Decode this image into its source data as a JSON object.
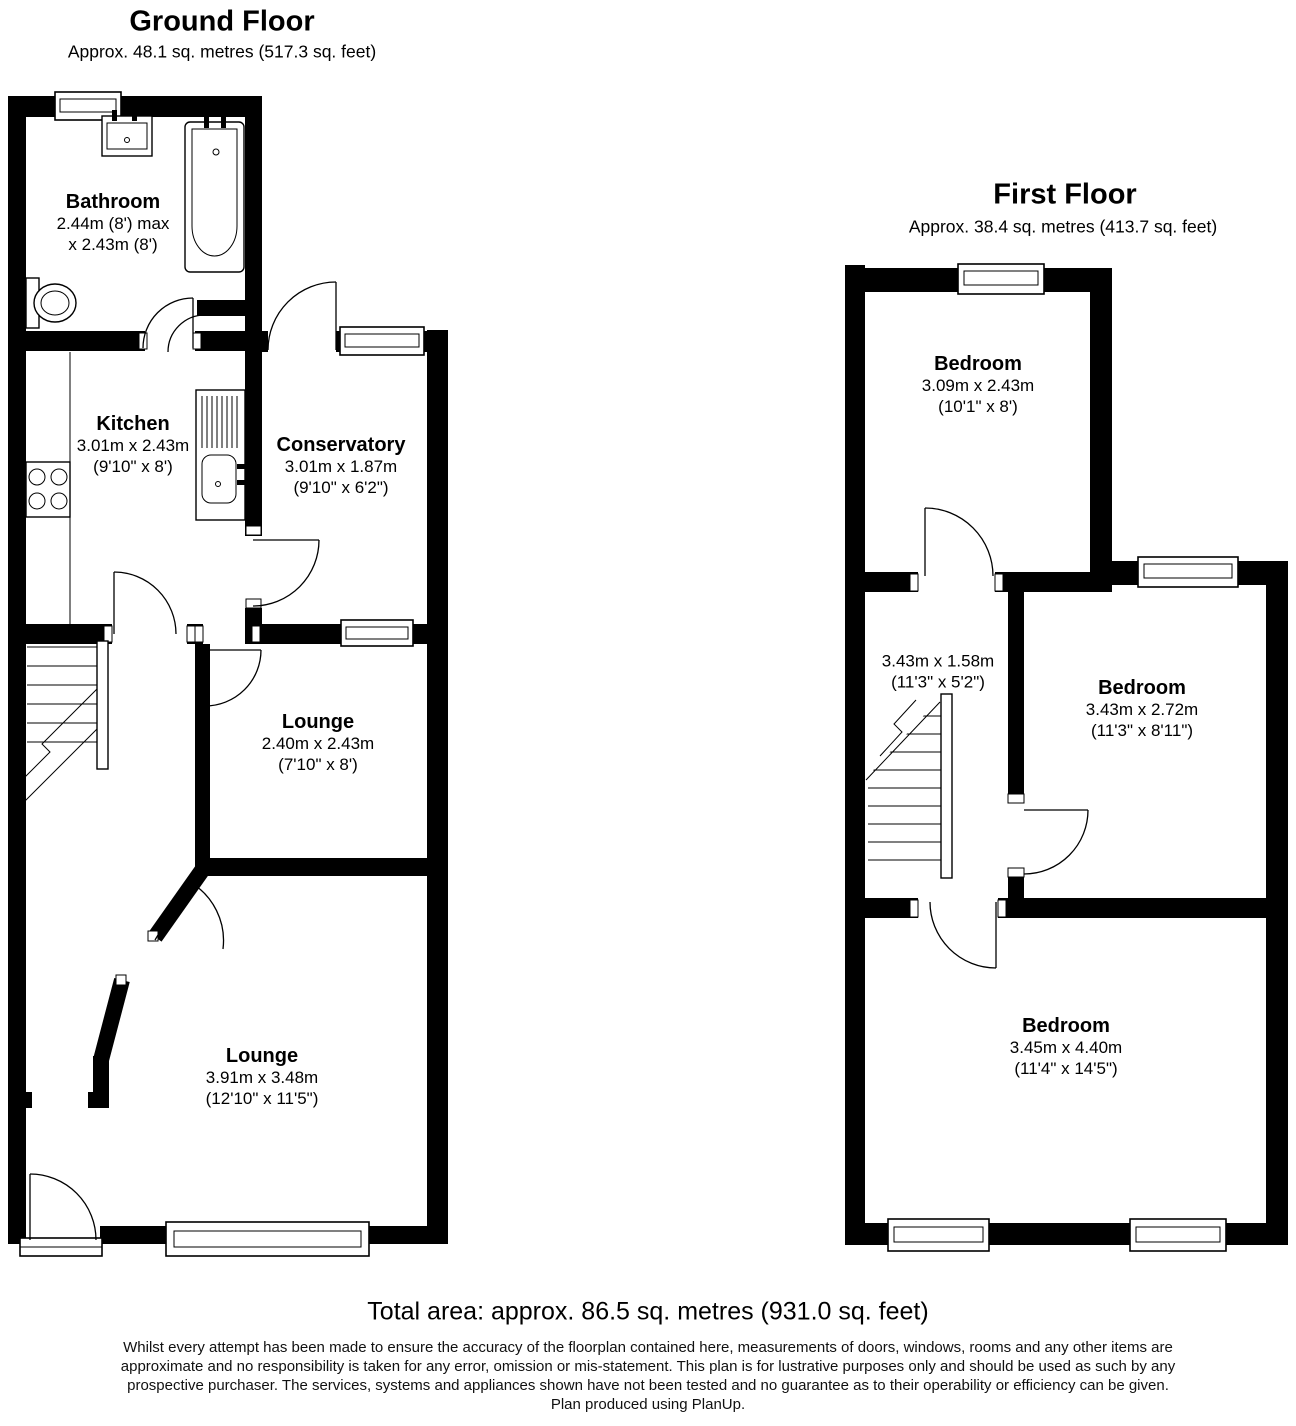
{
  "ground_floor": {
    "title": "Ground Floor",
    "subtitle": "Approx. 48.1 sq. metres (517.3 sq. feet)",
    "rooms": {
      "bathroom": {
        "name": "Bathroom",
        "dims_metric": "2.44m (8') max",
        "dims_imperial": "x 2.43m (8')"
      },
      "kitchen": {
        "name": "Kitchen",
        "dims_metric": "3.01m x 2.43m",
        "dims_imperial": "(9'10\" x 8')"
      },
      "conservatory": {
        "name": "Conservatory",
        "dims_metric": "3.01m x 1.87m",
        "dims_imperial": "(9'10\" x 6'2\")"
      },
      "lounge_small": {
        "name": "Lounge",
        "dims_metric": "2.40m x 2.43m",
        "dims_imperial": "(7'10\" x 8')"
      },
      "lounge_large": {
        "name": "Lounge",
        "dims_metric": "3.91m x 3.48m",
        "dims_imperial": "(12'10\" x 11'5\")"
      }
    }
  },
  "first_floor": {
    "title": "First Floor",
    "subtitle": "Approx. 38.4 sq. metres (413.7 sq. feet)",
    "rooms": {
      "bedroom_front": {
        "name": "Bedroom",
        "dims_metric": "3.09m x 2.43m",
        "dims_imperial": "(10'1\" x 8')"
      },
      "landing": {
        "dims_metric": "3.43m x 1.58m",
        "dims_imperial": "(11'3\" x 5'2\")"
      },
      "bedroom_middle": {
        "name": "Bedroom",
        "dims_metric": "3.43m x 2.72m",
        "dims_imperial": "(11'3\" x 8'11\")"
      },
      "bedroom_back": {
        "name": "Bedroom",
        "dims_metric": "3.45m x 4.40m",
        "dims_imperial": "(11'4\" x 14'5\")"
      }
    }
  },
  "footer": {
    "total_area": "Total area: approx. 86.5 sq. metres (931.0 sq. feet)",
    "disclaimer": [
      "Whilst every attempt has been made to ensure the accuracy of the floorplan contained here, measurements of doors, windows, rooms and any other items are",
      "approximate and no responsibility is taken for any error, omission or mis-statement. This plan is for lustrative purposes only and should be used as such by any",
      "prospective purchaser. The services, systems and appliances shown have not been tested and no guarantee as to their operability or efficiency can be given.",
      "Plan produced using PlanUp."
    ]
  },
  "fixtures": {
    "ground_floor": [
      "bath",
      "wash-basin",
      "toilet",
      "hob",
      "sink-drainer",
      "stairs"
    ],
    "first_floor": [
      "stairs"
    ]
  },
  "colors": {
    "wall": "#000000",
    "background": "#ffffff",
    "text": "#000000"
  }
}
